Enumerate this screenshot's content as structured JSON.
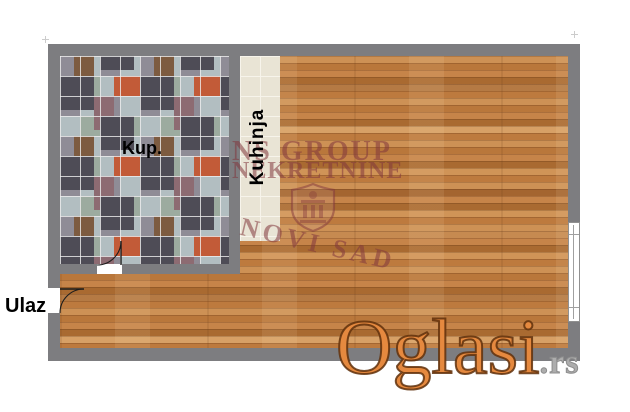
{
  "labels": {
    "bathroom": "Kup.",
    "kitchen": "Kuhinja",
    "entrance": "Ulaz"
  },
  "watermark": {
    "agency_line1": "NS GROUP",
    "agency_line2": "NEKRETNINE",
    "city": "NOVI SAD"
  },
  "logo": {
    "brand": "Oglasi",
    "tld": ".rs"
  },
  "colors": {
    "wall": "#7d7d80",
    "wood": "#c6854a",
    "kitchen_tile": "#e9e4d5",
    "bath_tile_dark": "#4e4c56",
    "bath_tile_light": "#b2bec1",
    "bath_tile_red": "#c25b38",
    "bath_tile_mauve": "#8d6b72",
    "watermark_color": "#8a3a40",
    "logo_orange": "#e5893f",
    "logo_gray": "#adadad"
  }
}
